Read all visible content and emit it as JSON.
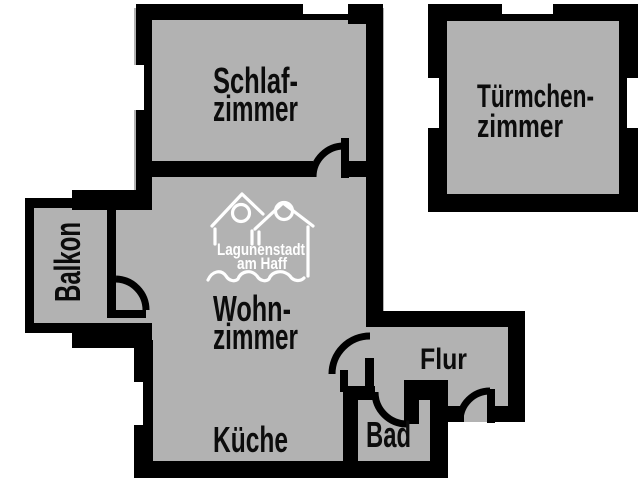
{
  "plan_title": "Apartment floor plan",
  "colors": {
    "floor_gray": "#b2b2b2",
    "wall_black": "#000000",
    "background_white": "#ffffff",
    "logo_white": "#ffffff",
    "label_black": "#0c0c0c"
  },
  "rooms": {
    "schlafzimmer": {
      "line1": "Schlaf-",
      "line2": "zimmer"
    },
    "tuermchenzimmer": {
      "line1": "Türmchen-",
      "line2": "zimmer"
    },
    "wohnzimmer": {
      "line1": "Wohn-",
      "line2": "zimmer"
    },
    "kueche": {
      "label": "Küche"
    },
    "bad": {
      "label": "Bad"
    },
    "flur": {
      "label": "Flur"
    },
    "balkon": {
      "label": "Balkon"
    }
  },
  "logo": {
    "line1": "Lagunenstadt",
    "line2": "am Haff"
  }
}
